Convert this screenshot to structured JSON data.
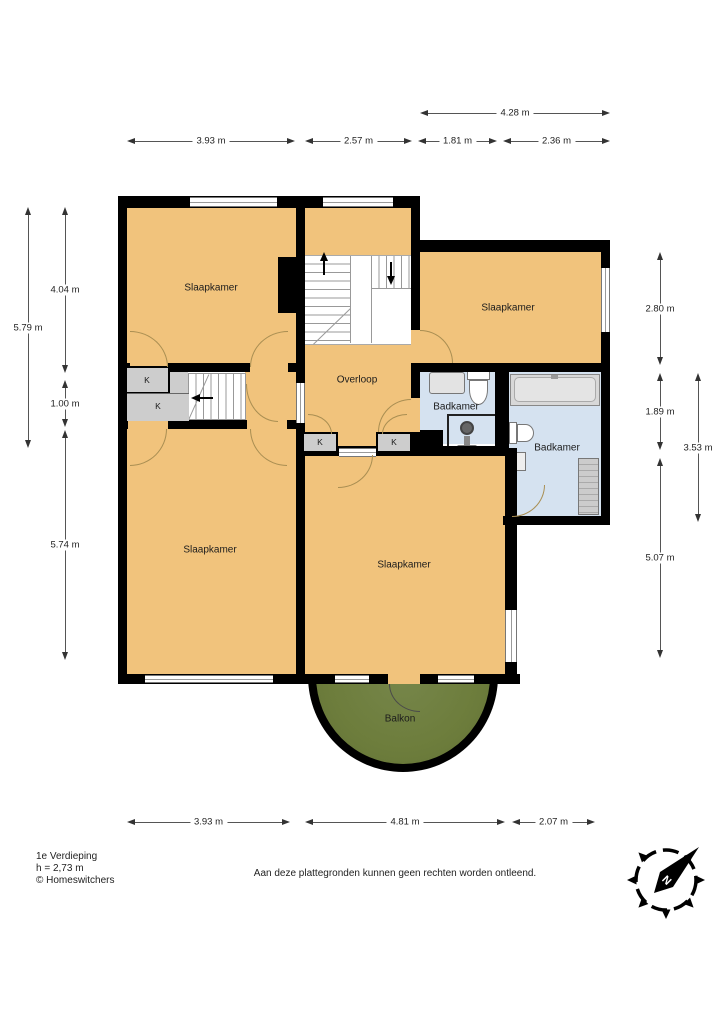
{
  "title_block": {
    "floor_title": "1e Verdieping",
    "height_note": "h = 2,73 m",
    "copyright": "© Homeswitchers",
    "disclaimer": "Aan deze plattegronden kunnen geen rechten worden ontleend."
  },
  "rooms": {
    "slaapkamer_top_left": "Slaapkamer",
    "slaapkamer_top_right": "Slaapkamer",
    "slaapkamer_bottom_left": "Slaapkamer",
    "slaapkamer_bottom_center": "Slaapkamer",
    "overloop": "Overloop",
    "badkamer_small": "Badkamer",
    "badkamer_large": "Badkamer",
    "balkon": "Balkon",
    "closet": "K"
  },
  "dimensions": {
    "top": [
      "4.28 m",
      "3.93 m",
      "2.57 m",
      "1.81 m",
      "2.36 m"
    ],
    "left": [
      "5.79 m",
      "4.04 m",
      "1.00 m",
      "5.74 m"
    ],
    "right": [
      "2.80 m",
      "1.89 m",
      "5.07 m",
      "3.53 m"
    ],
    "bottom": [
      "3.93 m",
      "4.81 m",
      "2.07 m"
    ]
  },
  "compass": {
    "north_label": "N"
  },
  "colors": {
    "floor": "#F1C37C",
    "bathroom": "#D5E2F0",
    "closet": "#CDCDCD",
    "balcony": "#6D7D3C",
    "wall": "#000000",
    "door_arc": "#A98E52"
  }
}
